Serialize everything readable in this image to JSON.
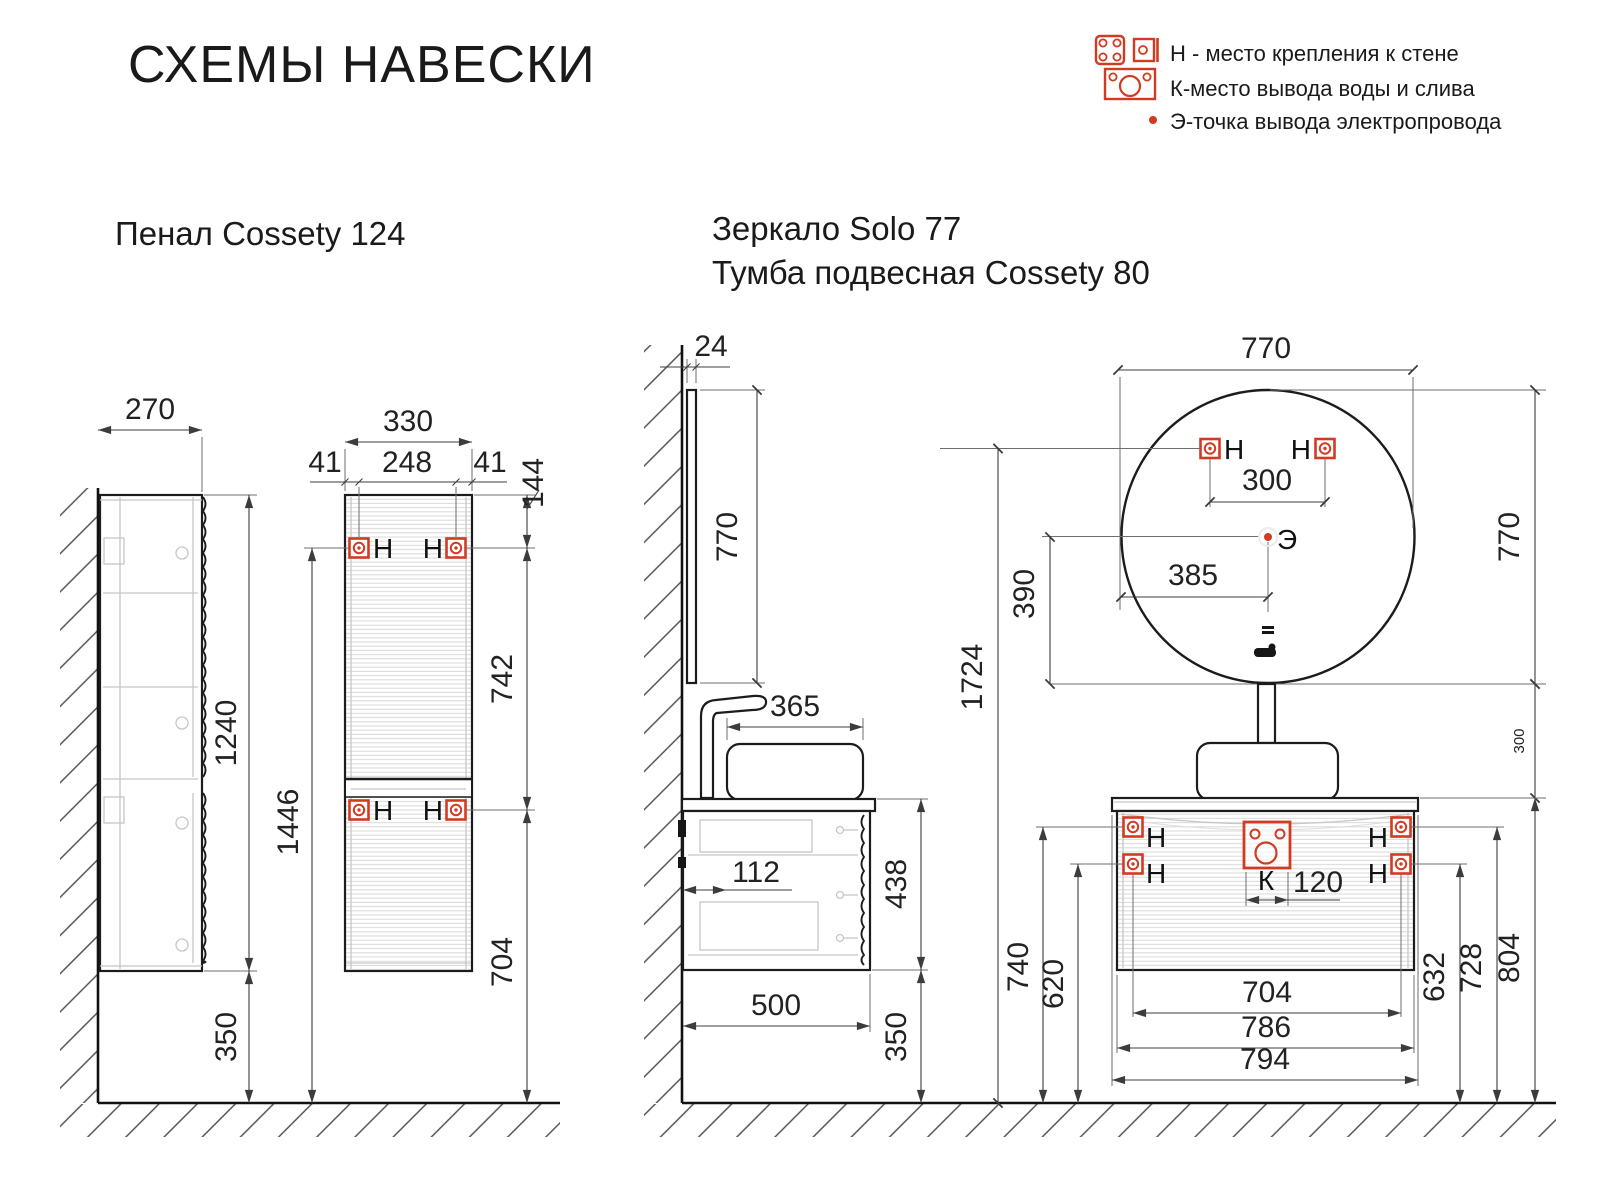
{
  "page": {
    "title": "СХЕМЫ НАВЕСКИ"
  },
  "legend": {
    "wall_mount": "Н - место крепления к стене",
    "water": "К-место вывода воды и слива",
    "electric": "Э-точка вывода электропровода"
  },
  "symbols": {
    "wall_mount": "Н",
    "water": "К",
    "electric": "Э"
  },
  "pencil": {
    "title": "Пенал Cossety 124",
    "dims": {
      "depth": "270",
      "width": "330",
      "edge_left": "41",
      "holes_span": "248",
      "edge_right": "41",
      "top_offset": "144",
      "height": "1240",
      "upper_holes_floor": "1446",
      "holes_gap": "742",
      "lower_holes_floor": "704",
      "clearance": "350"
    }
  },
  "mirror_vanity": {
    "title_mirror": "Зеркало Solo 77",
    "title_vanity": "Тумба подвесная Cossety 80",
    "dims": {
      "mirror_thickness": "24",
      "mirror_height": "770",
      "sink_depth": "365",
      "back_inset": "112",
      "vanity_height": "438",
      "vanity_depth": "500",
      "clearance": "350",
      "mirror_width": "770",
      "mirror_holes_span": "300",
      "electric_from_edge": "385",
      "electric_to_bottom": "390",
      "mirror_holes_floor": "1724",
      "mirror_height_right": "770",
      "mirror_gap": "300",
      "upper_holes_floor": "740",
      "lower_holes_floor": "620",
      "holes_span": "704",
      "body_width": "786",
      "total_width": "794",
      "drain_width": "120",
      "right_lower_holes_floor": "632",
      "right_upper_holes_floor": "728",
      "counter_floor": "804"
    }
  }
}
